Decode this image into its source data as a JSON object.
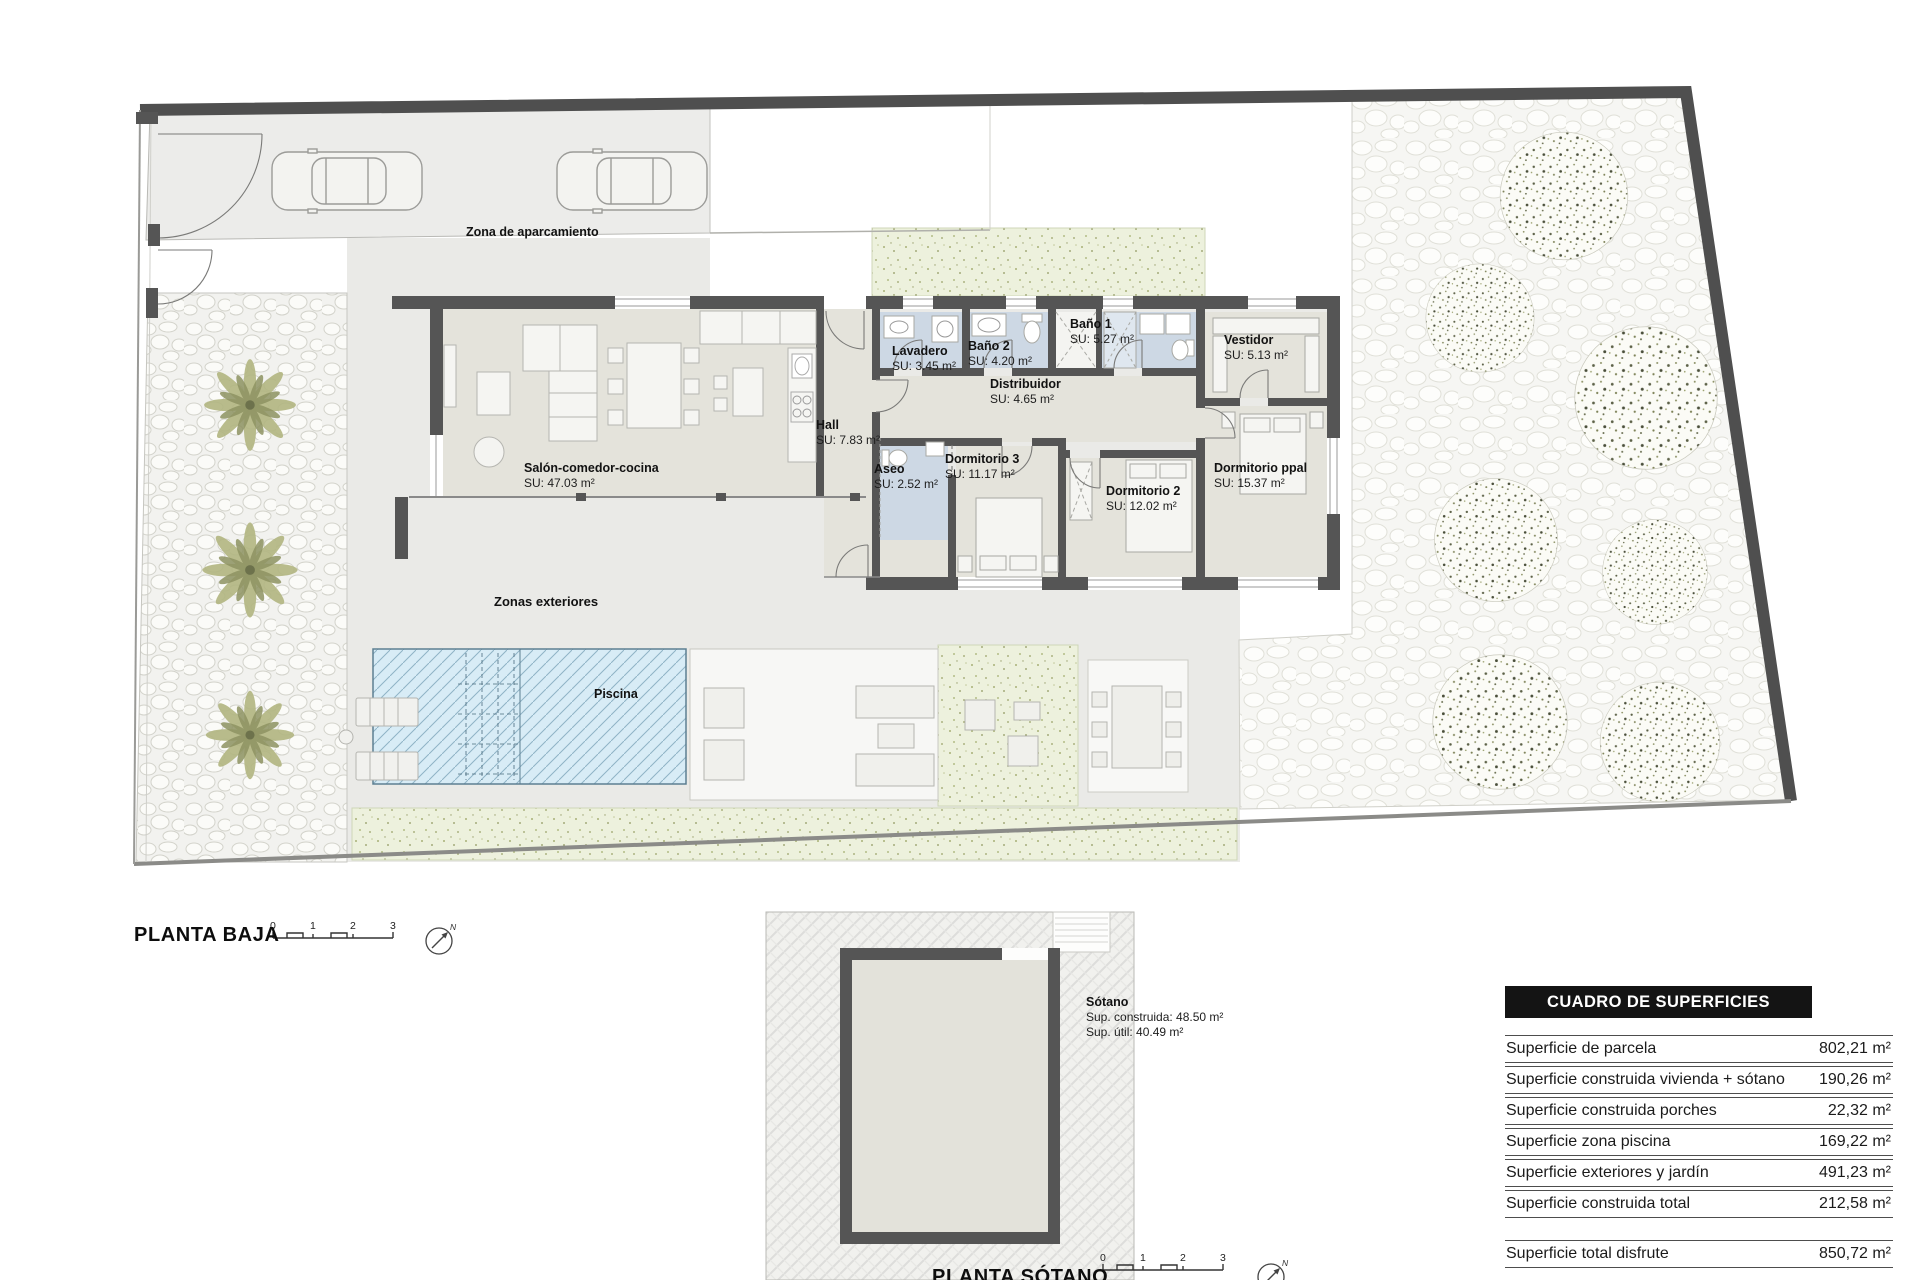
{
  "plan": {
    "floor_title": "PLANTA BAJA",
    "basement_title": "PLANTA SÓTANO",
    "scale_ticks": [
      "0",
      "1",
      "2",
      "3"
    ],
    "north_letter": "N"
  },
  "areas": {
    "parking_label": "Zona de aparcamiento",
    "exterior_label": "Zonas exteriores",
    "pool_label": "Piscina"
  },
  "rooms": {
    "salon": {
      "name": "Salón-comedor-cocina",
      "su": "SU: 47.03 m²"
    },
    "hall": {
      "name": "Hall",
      "su": "SU: 7.83 m²"
    },
    "lavadero": {
      "name": "Lavadero",
      "su": "SU: 3.45 m²"
    },
    "bano2": {
      "name": "Baño 2",
      "su": "SU: 4.20 m²"
    },
    "bano1": {
      "name": "Baño 1",
      "su": "SU: 5.27 m²"
    },
    "vestidor": {
      "name": "Vestidor",
      "su": "SU: 5.13 m²"
    },
    "distribuidor": {
      "name": "Distribuidor",
      "su": "SU: 4.65 m²"
    },
    "aseo": {
      "name": "Aseo",
      "su": "SU: 2.52 m²"
    },
    "dorm3": {
      "name": "Dormitorio 3",
      "su": "SU: 11.17 m²"
    },
    "dorm2": {
      "name": "Dormitorio 2",
      "su": "SU: 12.02 m²"
    },
    "dormppal": {
      "name": "Dormitorio ppal",
      "su": "SU: 15.37 m²"
    }
  },
  "basement": {
    "name": "Sótano",
    "built": "Sup. construida: 48.50 m²",
    "useful": "Sup. útil: 40.49 m²"
  },
  "surfaces_table": {
    "title": "CUADRO DE SUPERFICIES",
    "rows": [
      {
        "label": "Superficie de parcela",
        "value": "802,21 m²"
      },
      {
        "label": "Superficie construida vivienda + sótano",
        "value": "190,26 m²"
      },
      {
        "label": "Superficie construida porches",
        "value": "22,32 m²"
      },
      {
        "label": "Superficie zona piscina",
        "value": "169,22 m²"
      },
      {
        "label": "Superficie exteriores y jardín",
        "value": "491,23 m²"
      },
      {
        "label": "Superficie construida total",
        "value": "212,58 m²"
      }
    ],
    "total_row": {
      "label": "Superficie total disfrute",
      "value": "850,72 m²"
    }
  },
  "colors": {
    "wall": "#555555",
    "floor": "#e4e3db",
    "wet_room": "#cdd8e4",
    "pool": "#d8ecf6",
    "grass": "#edf1dd"
  }
}
